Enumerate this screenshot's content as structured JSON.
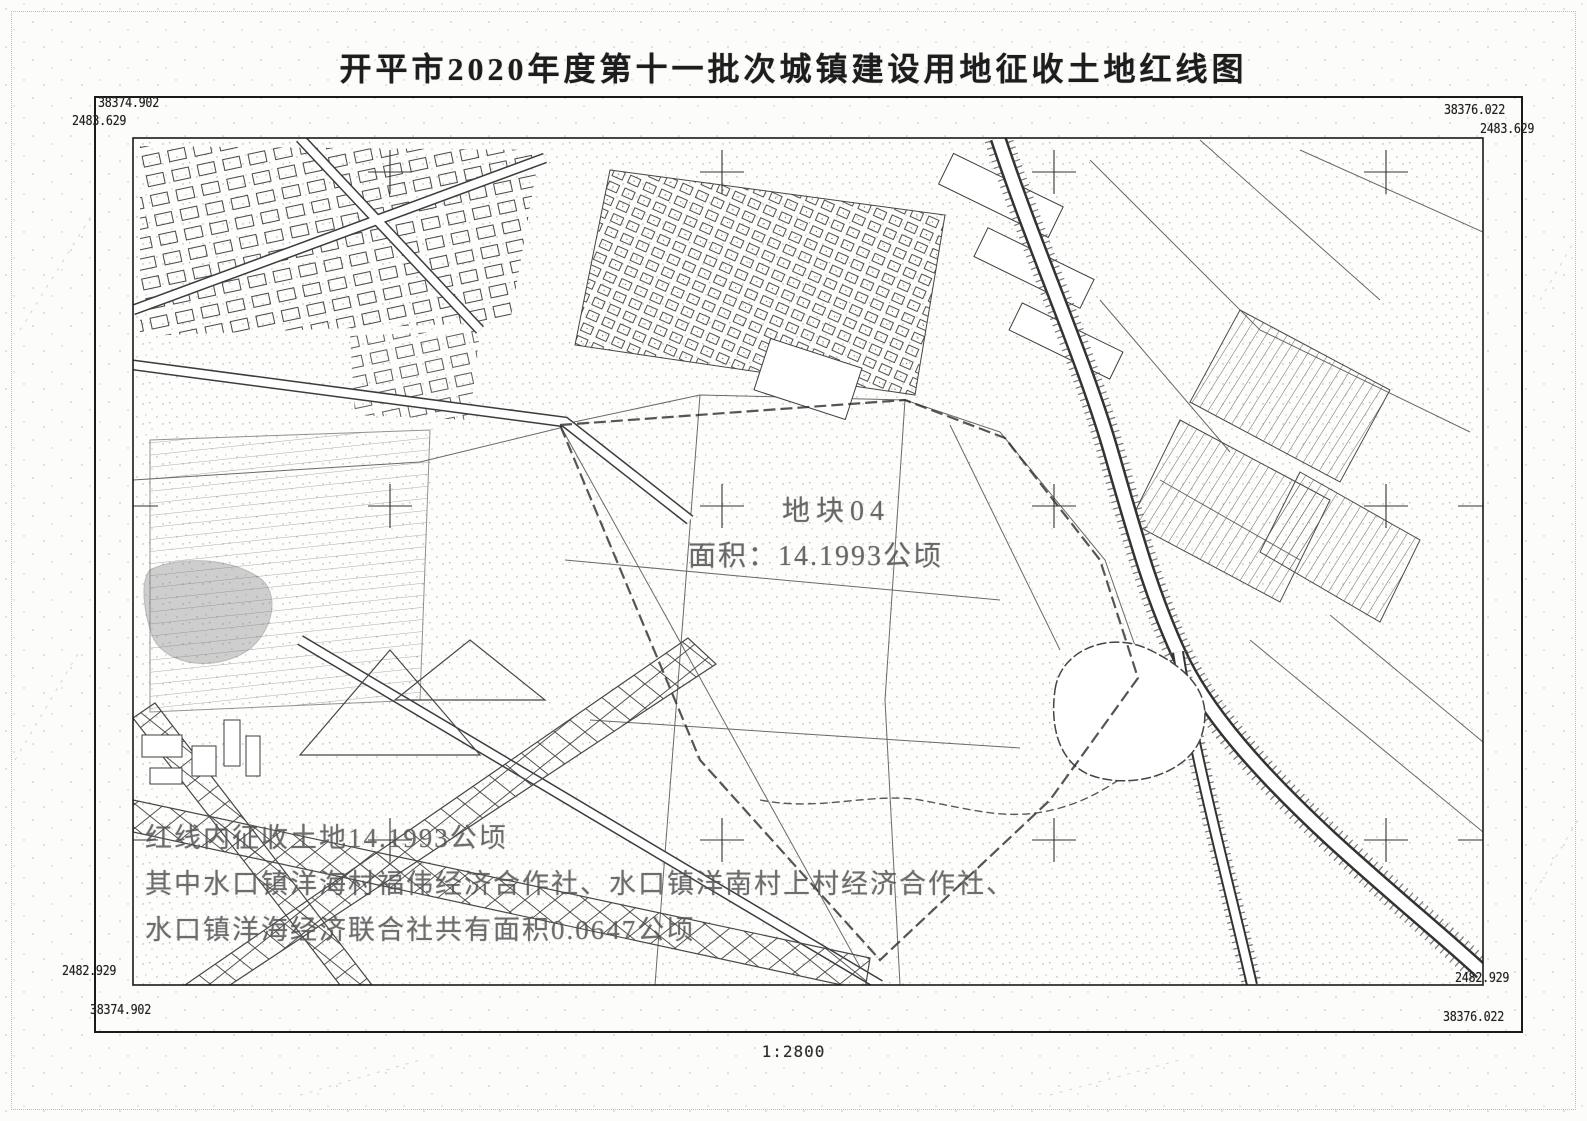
{
  "page": {
    "title": "开平市2020年度第十一批次城镇建设用地征收土地红线图",
    "scale_label": "1:2800"
  },
  "colors": {
    "ink": "#1c1c1c",
    "faded_ink": "#4f4f4f",
    "paper": "#fcfcfb"
  },
  "map": {
    "corners": {
      "top_left_x": "38374.902",
      "top_left_y": "2483.629",
      "top_right_x": "38376.022",
      "top_right_y": "2483.629",
      "bottom_left_y": "2482.929",
      "bottom_left_x": "38374.902",
      "bottom_right_y": "2482.929",
      "bottom_right_x": "38376.022"
    },
    "parcel": {
      "id": "地块04",
      "area": "面积：14.1993公顷"
    },
    "annotations": {
      "line1": "红线内征收土地14.1993公顷",
      "line2": "其中水口镇洋海村福伟经济合作社、水口镇洋南村上村经济合作社、",
      "line3": "水口镇洋海经济联合社共有面积0.0647公顷"
    }
  }
}
